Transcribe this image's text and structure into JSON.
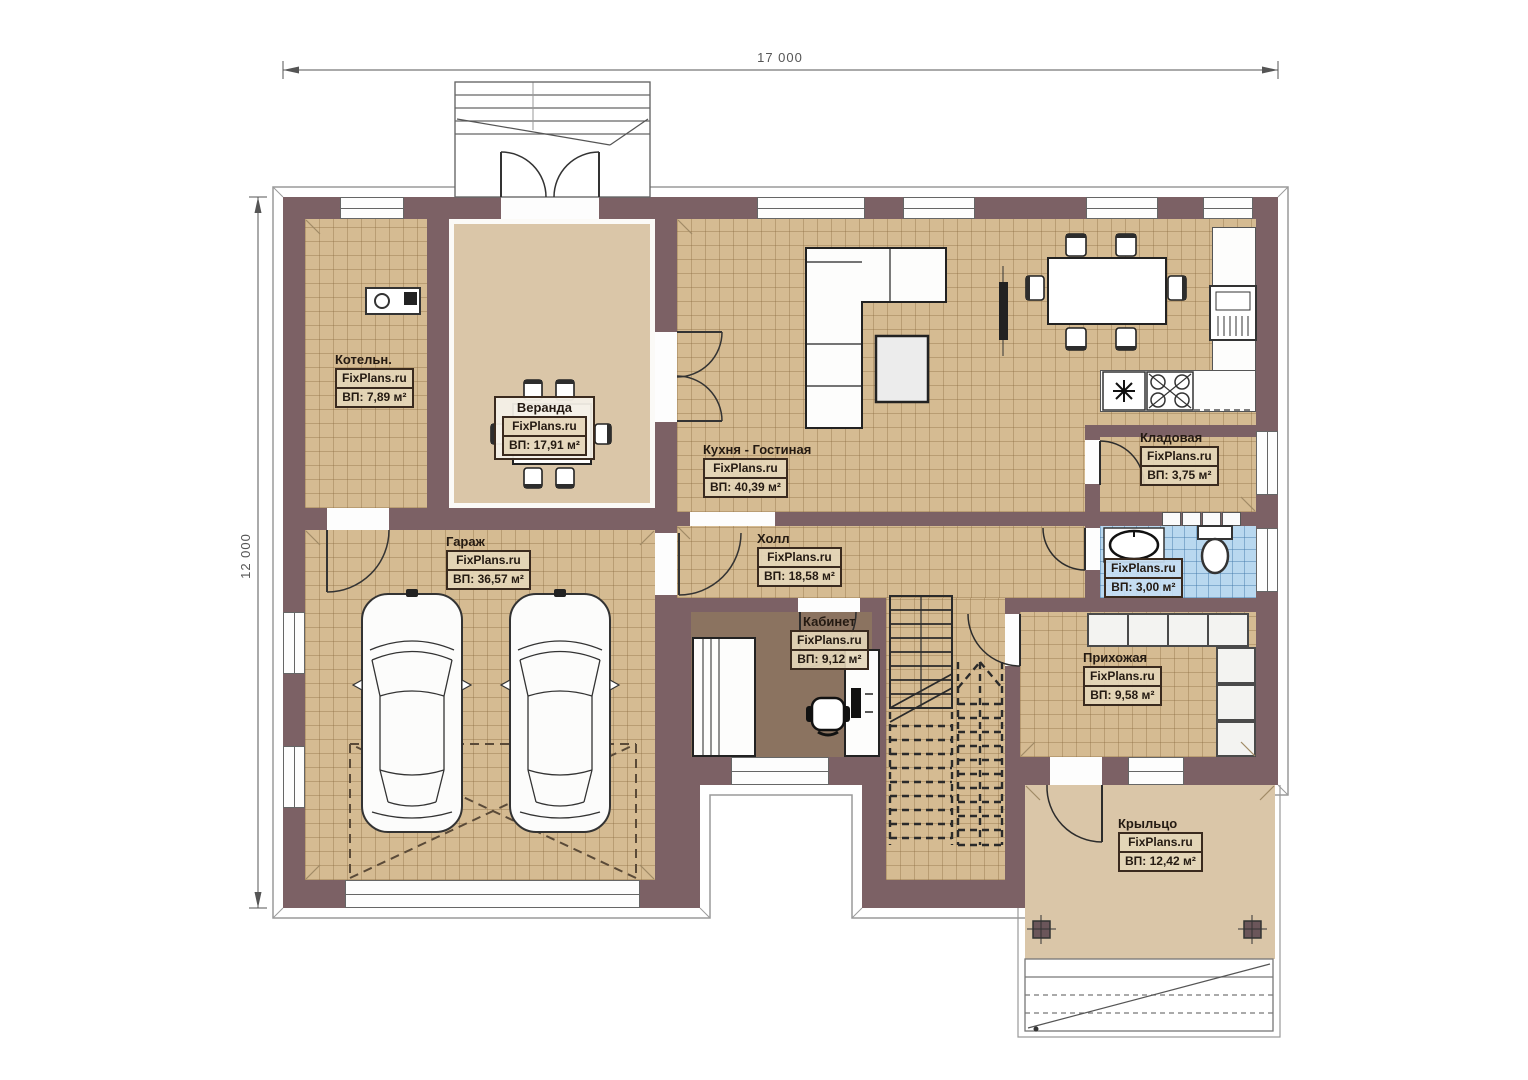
{
  "dimensions": {
    "top": "17 000",
    "left": "12 000"
  },
  "rooms": [
    {
      "id": "kotelnaya",
      "name": "Котельн.",
      "brand": "FixPlans.ru",
      "area": "ВП: 7,89 м²"
    },
    {
      "id": "veranda",
      "name": "Веранда",
      "brand": "FixPlans.ru",
      "area": "ВП: 17,91 м²"
    },
    {
      "id": "kitchen_living",
      "name": "Кухня - Гостиная",
      "brand": "FixPlans.ru",
      "area": "ВП: 40,39 м²"
    },
    {
      "id": "garage",
      "name": "Гараж",
      "brand": "FixPlans.ru",
      "area": "ВП: 36,57 м²"
    },
    {
      "id": "hall",
      "name": "Холл",
      "brand": "FixPlans.ru",
      "area": "ВП: 18,58 м²"
    },
    {
      "id": "office",
      "name": "Кабинет",
      "brand": "FixPlans.ru",
      "area": "ВП: 9,12 м²"
    },
    {
      "id": "pantry",
      "name": "Кладовая",
      "brand": "FixPlans.ru",
      "area": "ВП: 3,75 м²"
    },
    {
      "id": "bathroom",
      "name": "",
      "brand": "FixPlans.ru",
      "area": "ВП: 3,00 м²"
    },
    {
      "id": "entry_hall",
      "name": "Прихожая",
      "brand": "FixPlans.ru",
      "area": "ВП: 9,58 м²"
    },
    {
      "id": "porch",
      "name": "Крыльцо",
      "brand": "FixPlans.ru",
      "area": "ВП: 12,42 м²"
    }
  ],
  "colors": {
    "wall": "#7c6165",
    "tile_floor": "#d5bb92",
    "plain_floor": "#dac6a8",
    "office_floor": "#8b7360",
    "bath_tile": "#b9d8ef"
  }
}
